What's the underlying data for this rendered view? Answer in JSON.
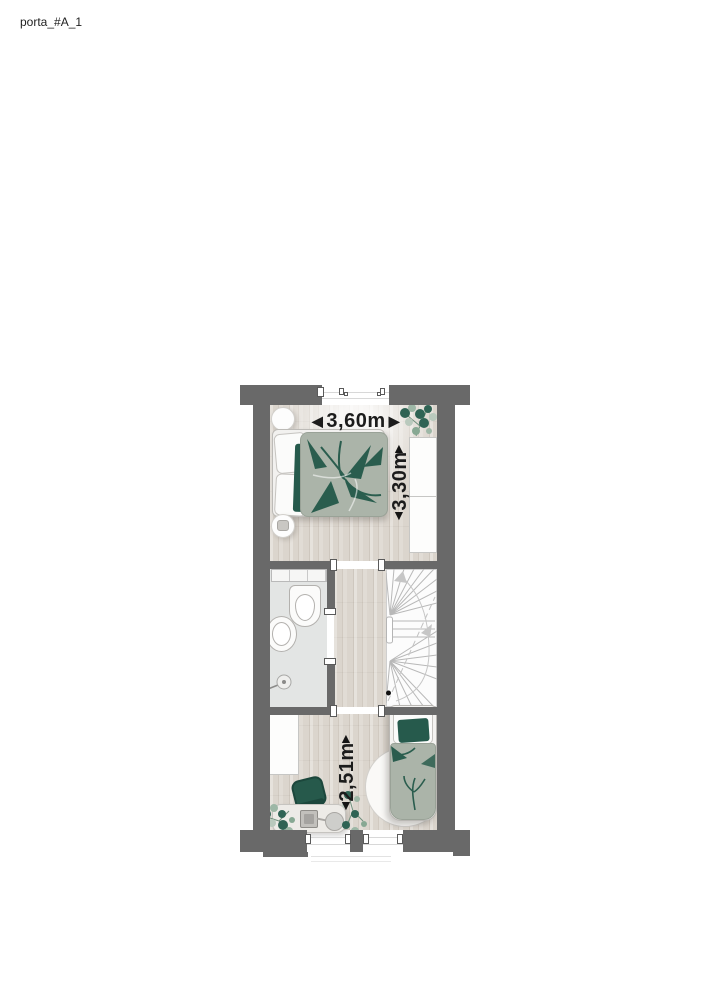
{
  "title": "porta_#A_1",
  "dimensions": {
    "width_back_bedroom": {
      "value": "3,60m",
      "left_arrow": "◀",
      "right_arrow": "▶"
    },
    "depth_back_bedroom": {
      "value": "3,30m",
      "up_arrow": "▲",
      "down_arrow": "▼"
    },
    "depth_front_bedroom": {
      "value": "2,51m",
      "up_arrow": "▲",
      "down_arrow": "▼"
    }
  },
  "colors": {
    "wall": "#696969",
    "accent_green": "#265a4c",
    "textile_sage": "#abb4a9",
    "wood_floor": "#dbd5cd",
    "bathroom_floor": "#e3e5e4",
    "dimension_text": "#1c1c1c"
  }
}
